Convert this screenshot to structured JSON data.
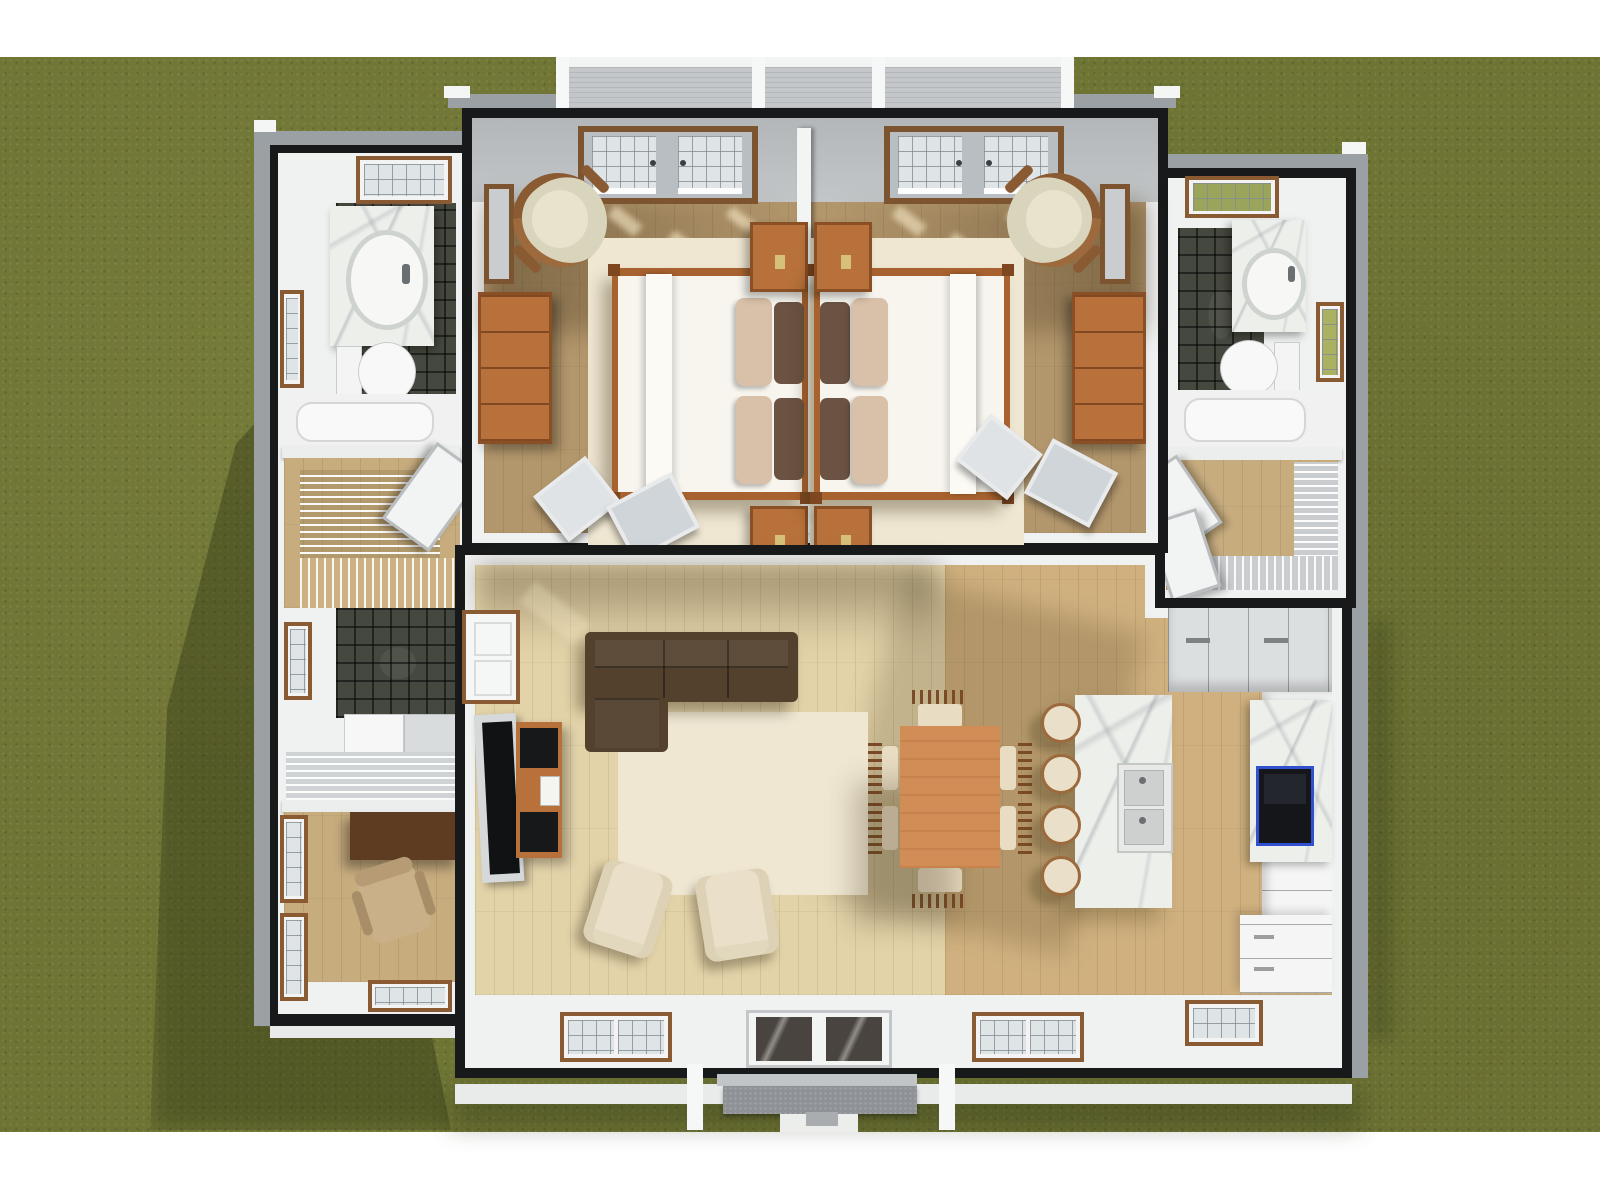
{
  "scene": {
    "title": "Overhead 3D floor-plan rendering of a single-story house",
    "view": "top-down dollhouse view, roof removed",
    "surroundings": "green grass lawn with white page border"
  },
  "palette": {
    "page_bg": "#ffffff",
    "grass": "#6e7434",
    "roof_fascia": "#17191a",
    "eave_gray": "#9aa0a3",
    "eave_white": "#e9ebeb",
    "wall_white": "#f0f1f1",
    "wall_shade": "#c2c6c8",
    "deck_gray": "#c4c7c9",
    "bedroom_floor": "#b2966c",
    "hall_floor": "#c7ac7e",
    "living_floor": "#e3d3a9",
    "kitchen_floor": "#cfb07e",
    "tile_dark": "#45483f",
    "marble_white": "#edefeb",
    "wood_orange": "#b8713a",
    "table_wood": "#d28d57",
    "desk_wood": "#5e3c22",
    "sofa_brown": "#53402d",
    "rug_cream": "#efe7d2",
    "chair_cream": "#eae0c9",
    "bed_white": "#f7f5ee",
    "pillow_tan": "#d9c0a8",
    "pillow_brown": "#6b5242",
    "tv_black": "#101214",
    "stove_black": "#14161a",
    "stove_blue": "#3050d0",
    "cabinet_gray": "#dcdfe0",
    "appliance_white": "#f4f5f4",
    "door_glass_dark": "#4a4440",
    "window_frame": "#8a5a33"
  },
  "exterior": {
    "lawn": "grass lawn",
    "rear_deck": "rear deck with white railing posts",
    "front_porch": "front porch steps and walkway",
    "front_door": "glass double front door"
  },
  "rooms": {
    "bedroom_left": {
      "label": "Bedroom 1",
      "items": {
        "french_doors": "french doors to rear deck",
        "accent_chair": "round-back accent chair",
        "wall_mirror": "framed wall mirror",
        "dresser": "wood dresser",
        "rug": "cream area rug",
        "bed": "double bed with white duvet, tan and brown pillows",
        "nightstand_top": "nightstand",
        "nightstand_bottom": "nightstand",
        "leaning_frames": "framed pictures leaning on wall"
      }
    },
    "bedroom_right": {
      "label": "Bedroom 2",
      "items": {
        "french_doors": "french doors to rear deck",
        "accent_chair": "round-back accent chair",
        "wall_mirror": "framed wall mirror",
        "dresser": "wood dresser",
        "rug": "cream area rug",
        "bed": "double bed with white duvet, tan and brown pillows",
        "nightstand_top": "nightstand",
        "nightstand_bottom": "nightstand",
        "leaning_frames": "framed pictures leaning on wall"
      }
    },
    "bathroom_left": {
      "label": "Bathroom 1",
      "items": {
        "window_north": "window",
        "window_west": "window",
        "vanity": "marble vanity with oval sink",
        "toilet": "toilet",
        "bathtub": "bathtub",
        "tile": "dark tile floor"
      }
    },
    "stair_hall": {
      "label": "Stair hall",
      "items": {
        "railing": "stair railing",
        "treads": "staircase treads",
        "open_door": "open door"
      }
    },
    "laundry": {
      "label": "Laundry",
      "items": {
        "window_west": "window",
        "washer_dryer": "washer and dryer",
        "landing_rail": "landing with wire railing"
      }
    },
    "office": {
      "label": "Office / den",
      "items": {
        "desk": "dark wood desk",
        "office_chair": "desk chair",
        "window_west_1": "window",
        "window_west_2": "window",
        "window_south": "window"
      }
    },
    "bathroom_right": {
      "label": "Bathroom 2",
      "items": {
        "window_north": "window",
        "window_east": "window",
        "vanity": "marble vanity with oval sink",
        "toilet": "toilet",
        "bathtub": "bathtub",
        "tile": "dark tile floor"
      }
    },
    "closet": {
      "label": "Walk-in closet",
      "items": {
        "shelf_east": "wire shelving",
        "shelf_south": "wire shelving",
        "doors": "open closet doors"
      }
    },
    "living_room": {
      "label": "Living room",
      "items": {
        "sofa": "brown sectional sofa with chaise",
        "rug": "cream area rug",
        "armchair_1": "cream armchair",
        "armchair_2": "cream armchair",
        "tv": "flat-screen TV",
        "console": "wood media console",
        "hall_door": "paneled door to hall",
        "window_south_1": "window",
        "window_south_2": "window"
      }
    },
    "dining": {
      "label": "Dining area",
      "items": {
        "table": "rectangular wood dining table",
        "chairs": "six slat-back dining chairs"
      }
    },
    "kitchen": {
      "label": "Kitchen",
      "items": {
        "island": "marble island with double sink",
        "stools": "four cream bar stools",
        "fridge_cabinets": "refrigerator and tall cabinets",
        "counter_east": "east wall counters",
        "backsplash": "marble backsplash",
        "stove": "range with blue-trimmed glass top",
        "base_cabinets": "base cabinets",
        "window_south": "window"
      }
    }
  }
}
